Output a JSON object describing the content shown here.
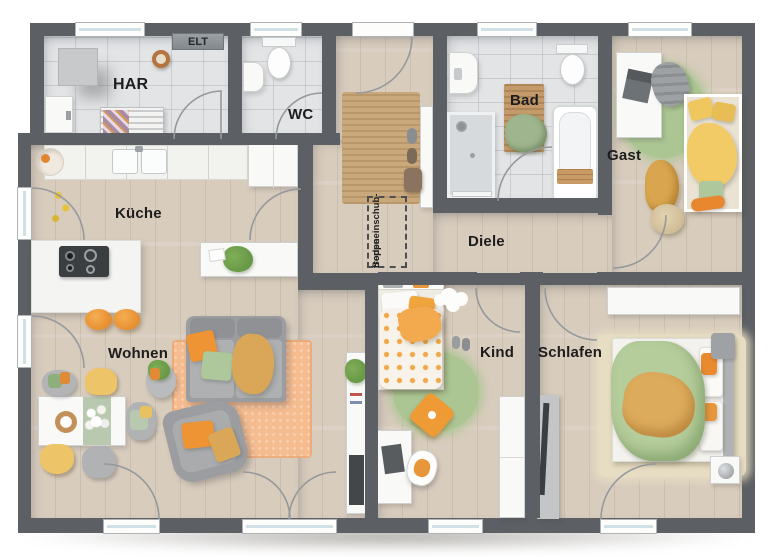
{
  "plan_type": "floor-plan",
  "colors": {
    "wall": "#5c6064",
    "wood_floor": "#d8ccbd",
    "tile_floor": "#e2e4e6",
    "accent_orange": "#ee9a35",
    "accent_yellow": "#eec469",
    "accent_green": "#abc593",
    "rug_beige": "#c9a87b",
    "rug_orange": "#f5bc90",
    "window_glass": "#cfe0e7"
  },
  "rooms": {
    "har": {
      "label": "HAR"
    },
    "elt": {
      "label": "ELT"
    },
    "wc": {
      "label": "WC"
    },
    "bad": {
      "label": "Bad"
    },
    "gast": {
      "label": "Gast"
    },
    "kueche": {
      "label": "Küche"
    },
    "diele": {
      "label": "Diele"
    },
    "wohnen": {
      "label": "Wohnen"
    },
    "kind": {
      "label": "Kind"
    },
    "schlafen": {
      "label": "Schlafen"
    }
  },
  "annotations": {
    "attic_hatch": {
      "line1": "Bodeneinschub-",
      "line2": "treppe"
    }
  },
  "furniture_icons": [
    "washing-machine-icon",
    "drying-rack-icon",
    "storage-box-icon",
    "cable-coil-icon",
    "toilet-icon",
    "hand-basin-icon",
    "bathtub-icon",
    "shower-icon",
    "bath-mat-icon",
    "towel-icon",
    "kitchen-counter-icon",
    "kitchen-sink-icon",
    "fridge-icon",
    "kitchen-island-icon",
    "cooktop-icon",
    "bar-stool-icon",
    "sideboard-icon",
    "houseplant-icon",
    "dining-table-icon",
    "chair-icon",
    "sofa-icon",
    "armchair-icon",
    "rug-icon",
    "tv-bench-icon",
    "bed-icon",
    "desk-icon",
    "desk-chair-icon",
    "laptop-icon",
    "wardrobe-icon",
    "nightstand-icon",
    "lamp-icon",
    "pouf-icon",
    "entrance-door-icon",
    "window-icon",
    "door-swing-icon",
    "shoes-icon",
    "bag-icon",
    "cloud-decor-icon"
  ]
}
